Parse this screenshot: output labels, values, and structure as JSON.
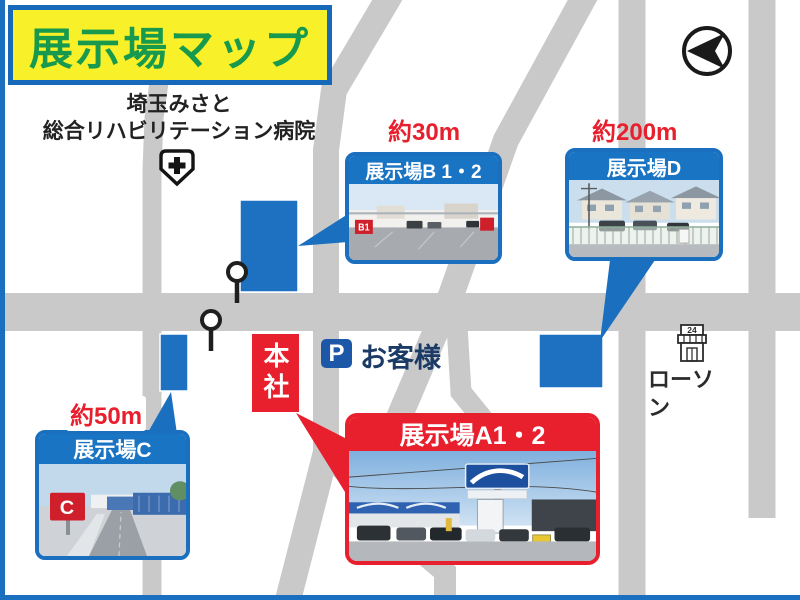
{
  "title": "展示場マップ",
  "hospital": {
    "line1": "埼玉みさと",
    "line2": "総合リハビリテーション病院"
  },
  "sites": {
    "b": {
      "name": "展示場B 1・2",
      "distance": "約30m",
      "photo_label": "B1"
    },
    "d": {
      "name": "展示場D",
      "distance": "約200m"
    },
    "c": {
      "name": "展示場C",
      "distance": "約50m",
      "photo_label": "C"
    },
    "a": {
      "name": "展示場A1・2"
    }
  },
  "headquarters": "本社",
  "parking": {
    "icon": "P",
    "label": "お客様"
  },
  "store": {
    "badge": "24",
    "name": "ローソン"
  },
  "colors": {
    "accent_blue": "#1a6fbf",
    "marker_blue": "#1e70c0",
    "accent_red": "#e8202e",
    "title_bg": "#f8f028",
    "title_text": "#189a4e",
    "road_gray": "#c9c9c9"
  }
}
